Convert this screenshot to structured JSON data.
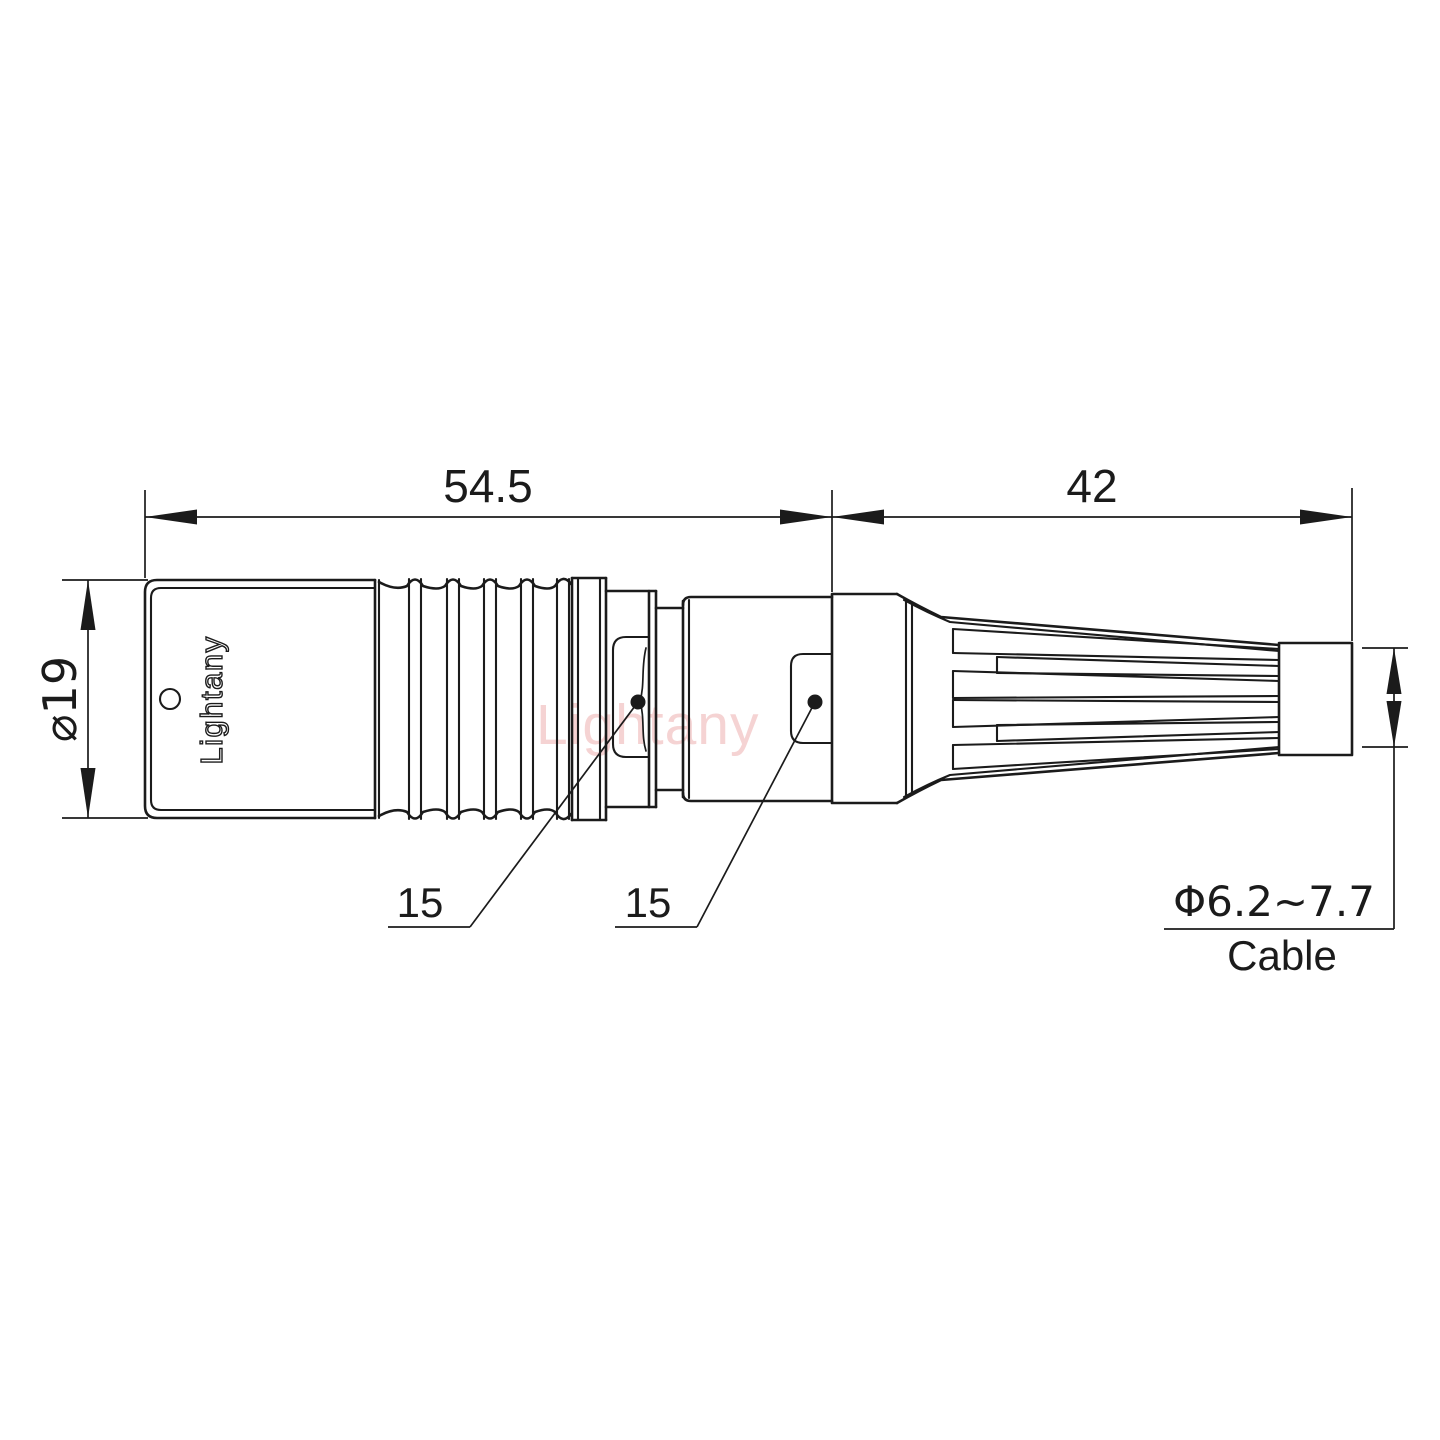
{
  "drawing": {
    "watermark": "Lightany",
    "body_logo": "Lightany",
    "dimensions": {
      "front_length": "54.5",
      "rear_length": "42",
      "body_diameter": "⌀19",
      "nut_flat_left": "15",
      "nut_flat_right": "15",
      "cable_range": "Φ6.2~7.7",
      "cable_label": "Cable"
    },
    "colors": {
      "line": "#1b1b1b",
      "watermark_pink": "#e07070",
      "background": "#ffffff"
    }
  }
}
